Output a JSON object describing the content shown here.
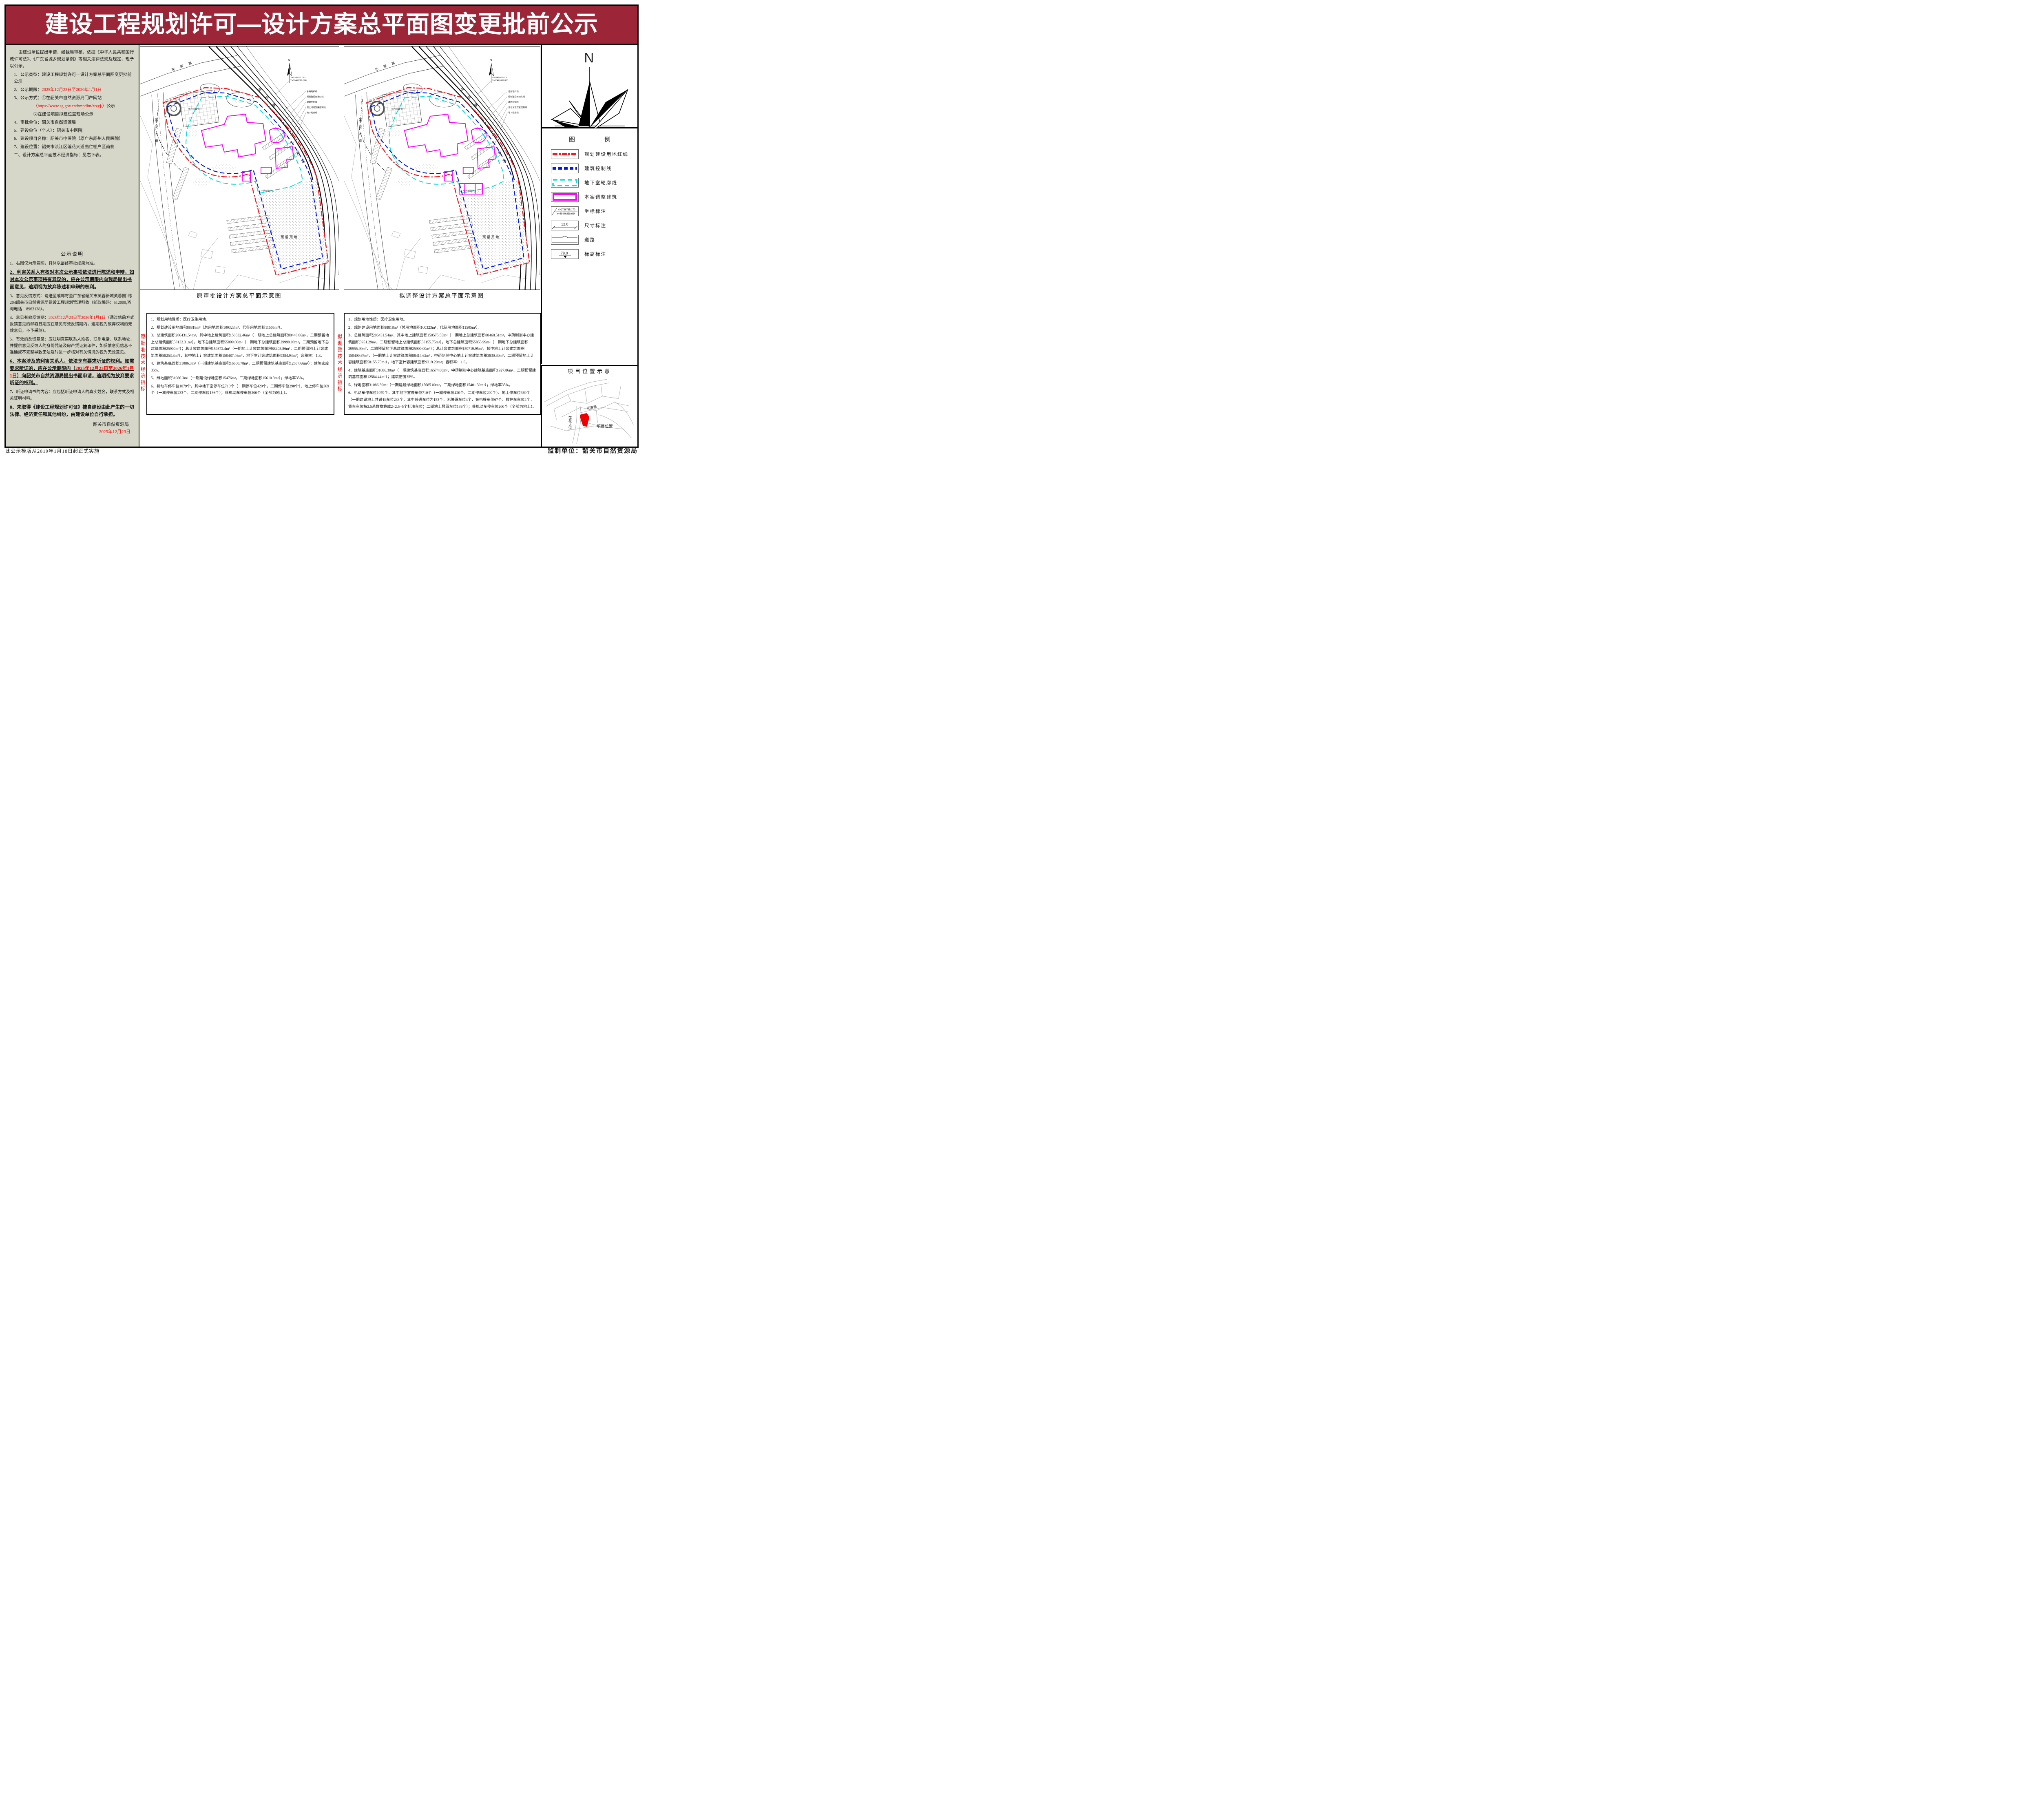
{
  "title": "建设工程规划许可—设计方案总平面图变更批前公示",
  "colors": {
    "banner": "#9c2638",
    "accent_red": "#f20000",
    "line_red": "#ee1c25",
    "line_blue": "#0018e8",
    "line_cyan": "#00dddd",
    "line_magenta": "#ff00ff",
    "sidebar_bg": "#d6d7c8"
  },
  "sidebar": {
    "intro": "由建设单位提出申请，经我局审核，依据《中华人民共和国行政许可法》、《广东省城乡规划条例》等相关法律法规及规定，现予以公示。",
    "item1": "1、公示类型：建设工程规划许可—设计方案总平面图变更批前公示",
    "item2_label": "2、公示期限：",
    "item2_date": "2025年12月23日至2026年1月1日",
    "item3_line1": "3、公示方式：①在韶关市自然资源局门户网站",
    "item3_url": "（https://www.sg.gov.cn/bmpdlm/zrzyj/）",
    "item3_url_suffix": "公示",
    "item3_line2": "②在建设项目拟建位置现场公示",
    "item4": "4、审批单位：韶关市自然资源局",
    "item5": "5、建设单位（个人）：韶关市中医院",
    "item6": "6、建设项目名称：韶关市中医院（原广东韶州人民医院）",
    "item7": "7、建设位置：韶关市浈江区莲花大道曲仁棚户区南侧",
    "item8": "二、设计方案总平面技术经济指标：见右下表。",
    "notice_heading": "公示说明",
    "note1": "1、右图仅为示意图，具体以最终审批成果为准。",
    "note2": "2、利害关系人有权对本次公示事项依法进行陈述和申辩，如对本次公示事项持有异议的，应在公示期限内向我局提出书面意见，逾期视为放弃陈述和申辩的权利。",
    "note3": "3、意见反馈方式：请送至或邮寄至广东省韶关市芙蓉新城芙蓉园1栋204韶关市自然资源局建设工程规划管理科收（邮政编码：512000,咨询电话：8963138）。",
    "note4_pre": "4、意见有效反馈期：",
    "note4_date": "2025年12月23日至2026年1月1日",
    "note4_post": "（通过信函方式反馈意见的邮戳日期应在意见有效反馈期内，逾期视为放弃权利的无效意见，不予采纳）。",
    "note5": "5、有效的反馈意见：应注明真实联系人姓名、联系电话、联系地址，并提供意见反馈人的身份凭证及房产凭证复印件，如反馈意见信息不准确或不完整导致无法及时进一步核对有关情况的视为无效意见。",
    "note6_pre": "6、本案涉及的利害关系人，依法享有要求听证的权利。如需要求听证的，应在公示期限内（",
    "note6_date": "2025年12月23日至2026年1月1日",
    "note6_post": "）向韶关市自然资源局提出书面申请，逾期视为放弃要求听证的权利。",
    "note7": "7、听证申请书的内容：应包括听证申请人的真实姓名，联系方式及相关证明材料。",
    "note8": "8、未取得《建设工程规划许可证》擅自建设由此产生的一切法律、经济责任和其他纠纷，由建设单位自行承担。",
    "signature": "韶关市自然资源局",
    "sign_date": "2025年12月23日"
  },
  "plan": {
    "left_caption": "原审批设计方案总平面示意图",
    "right_caption": "拟调整设计方案总平面示意图",
    "labels": {
      "north": "N",
      "road_top": "花寨路",
      "road_left": "莲花大道",
      "road_diag": "规划路",
      "river": "陂河",
      "reserved": "预留用地",
      "bldg1": "体检行政中心",
      "bldg2": "中药制剂中心",
      "leaders": [
        "总用地红线",
        "规划建设用地红线",
        "建筑控制线",
        "退让河道宽度控制线",
        "地下轮廓线"
      ],
      "coord1_x": "X=2745662.013",
      "coord1_y": "Y=38462689.808"
    }
  },
  "tech": {
    "original": {
      "side_label": "原批准技术经济指标",
      "items": [
        "1、规划用地性质：医疗卫生用地。",
        "2、规划建设用地面积88818m²（总用地面积100323m²，代征用地面积11505m²）。",
        "3、总建筑面积206431.54m²，其中地上建筑面积150532.46m²（一期地上总建筑面积88448.86m²，二期预留地上总建筑面积58132.31m²），地下总建筑面积55899.08m²（一期地下总建筑面积29999.08m²，二期预留地下总建筑面积25900m²）；总计容建筑面积159872.4m²（一期地上计容建筑面积88403.86m²，二期预留地上计容建筑面积58253.3m²），其中地上计容建筑面积150487.46m²，地下室计容建筑面积9384.94m²；容积率：1.8。",
        "4、建筑基底面积31086.3m²（一期建筑基底面积16600.78m²，二期预留建筑基底面积12557.66m²）；建筑密度35%。",
        "5、绿地面积31086.3m²（一期建设绿地面积15476m²，二期绿地面积15610.3m²）；绿地率35%。",
        "6、机动车停车位1079个，其中地下室停车位710个（一期停车位420个，二期停车位290个）、地上停车位369个（一期停车位233个，二期停车位136个）；非机动车停车位200个（全部为地上）。"
      ]
    },
    "adjusted": {
      "side_label": "拟调整技术经济指标",
      "items": [
        "1、规划用地性质：医疗卫生用地。",
        "2、规划建设用地面积88818m²（总用地面积100323m²，代征用地面积11505m²）。",
        "3、总建筑面积206431.54m²，其中地上建筑面积150575.55m²（一期地上总建筑面积88468.51m²，中药制剂中心建筑面积3951.29m²，二期预留地上总建筑面积58155.75m²），地下总建筑面积55855.99m²（一期地下总建筑面积29955.99m²，二期预留地下总建筑面积25900.00m²）；总计容建筑面积159719.95m²，其中地上计容建筑面积150400.67m²，（一期地上计容建筑面积88414.62m²，中药制剂中心地上计容建筑面积3830.30m²，二期预留地上计容建筑面积58155.75m²），地下室计容建筑面积9319.28m²；容积率：1.8。",
        "4、建筑基底面积31086.30m²（一期建筑基底面积16574.00m²，中药制剂中心建筑基底面积1927.86m²，二期预留建筑基底面积12584.44m²）；建筑密度35%。",
        "5、绿地面积31086.30m²（一期建设绿地面积15685.00m²，二期绿地面积15401.30m²）；绿地率35%。",
        "6、机动车停车位1079个，其中地下室停车位710个（一期停车位420个，二期停车位290个）、地上停车位369个（一期建设地上共设有车位233个，其中普通车位为153个，无障碍车位4个，充电桩车位67个，救护车车位4个，货车车位按2.5系数换算成2×2.5=5个标准车位；二期地上预留车位136个）；非机动车停车位200个（全部为地上）。"
      ]
    }
  },
  "compass": {
    "n": "N"
  },
  "legend": {
    "title": "图　　例",
    "items": [
      {
        "label": "规划建设用地红线"
      },
      {
        "label": "建筑控制线"
      },
      {
        "label": "地下室轮廓线"
      },
      {
        "label": "本案调整建筑"
      },
      {
        "label": "坐标标注",
        "x": "X=2736785.170",
        "y": "Y=38446838.694"
      },
      {
        "label": "尺寸标注",
        "value": "12.0"
      },
      {
        "label": "道路"
      },
      {
        "label": "标高标注",
        "value": "79.0"
      }
    ]
  },
  "location": {
    "title": "项目位置示意",
    "road1": "花寨路",
    "road2": "莲花大道",
    "site_label": "项目位置"
  },
  "footer": {
    "note": "此公示模版从2019年1月18日起正式实施",
    "supervisor": "监制单位：韶关市自然资源局"
  }
}
